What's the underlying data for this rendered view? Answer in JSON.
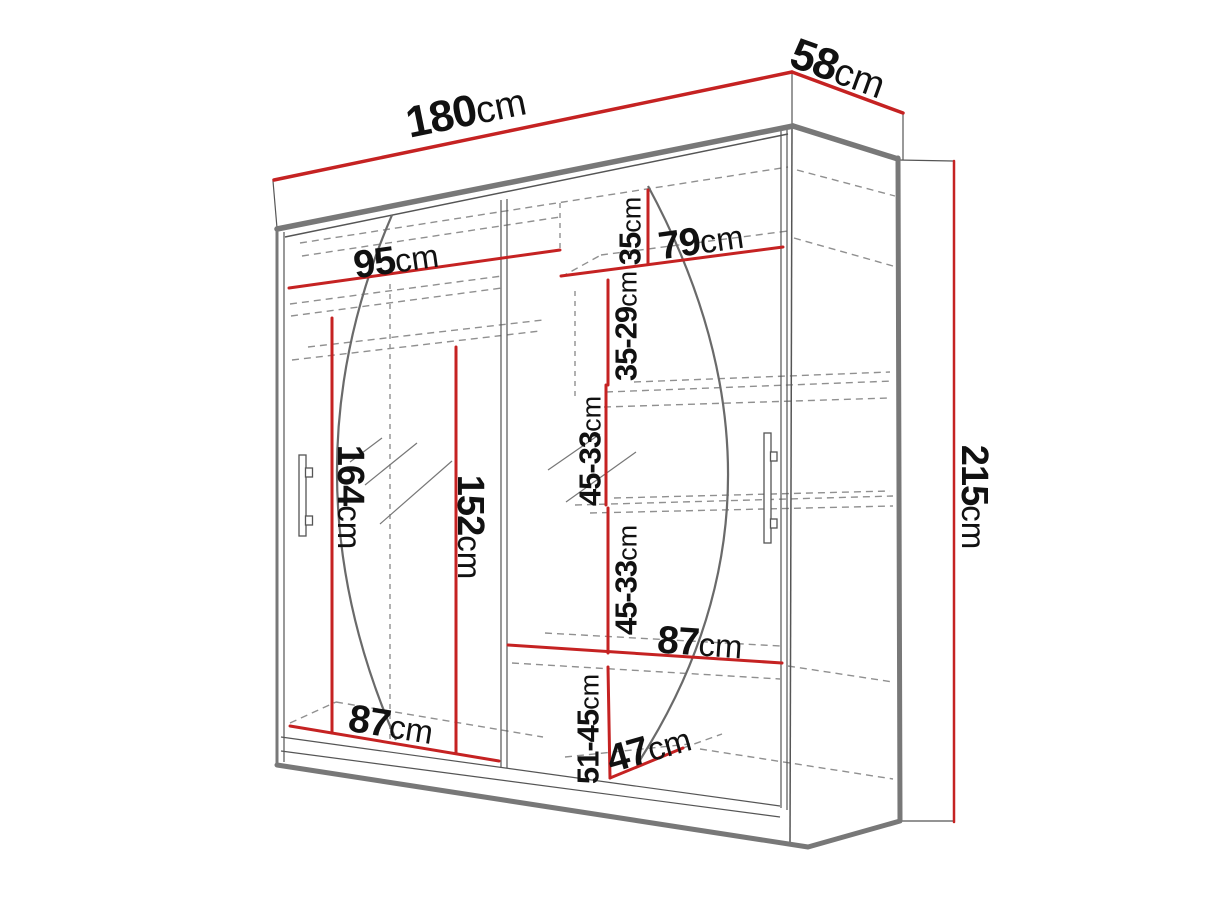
{
  "diagram": {
    "kind": "wardrobe-dimension-diagram",
    "accent_color": "#c52222",
    "outline_color": "#787878",
    "dashed_color": "#909090",
    "unit": "cm",
    "dimensions": {
      "width_total": {
        "value": "180",
        "unit": "cm"
      },
      "depth_total": {
        "value": "58",
        "unit": "cm"
      },
      "height_total": {
        "value": "215",
        "unit": "cm"
      },
      "section_left_width": {
        "value": "95",
        "unit": "cm"
      },
      "section_right_width": {
        "value": "79",
        "unit": "cm"
      },
      "gap_top_right": {
        "value": "35",
        "unit": "cm"
      },
      "gap_second_right": {
        "value": "35-29",
        "unit": "cm"
      },
      "gap_third_right": {
        "value": "45-33",
        "unit": "cm"
      },
      "gap_fourth_right": {
        "value": "45-33",
        "unit": "cm"
      },
      "hanging_height_left": {
        "value": "164",
        "unit": "cm"
      },
      "inner_height_left": {
        "value": "152",
        "unit": "cm"
      },
      "shelf_width_middle": {
        "value": "87",
        "unit": "cm"
      },
      "shelf_width_bottom": {
        "value": "87",
        "unit": "cm"
      },
      "gap_bottom_right": {
        "value": "51-45",
        "unit": "cm"
      },
      "shelf_depth_bottom": {
        "value": "47",
        "unit": "cm"
      }
    }
  }
}
